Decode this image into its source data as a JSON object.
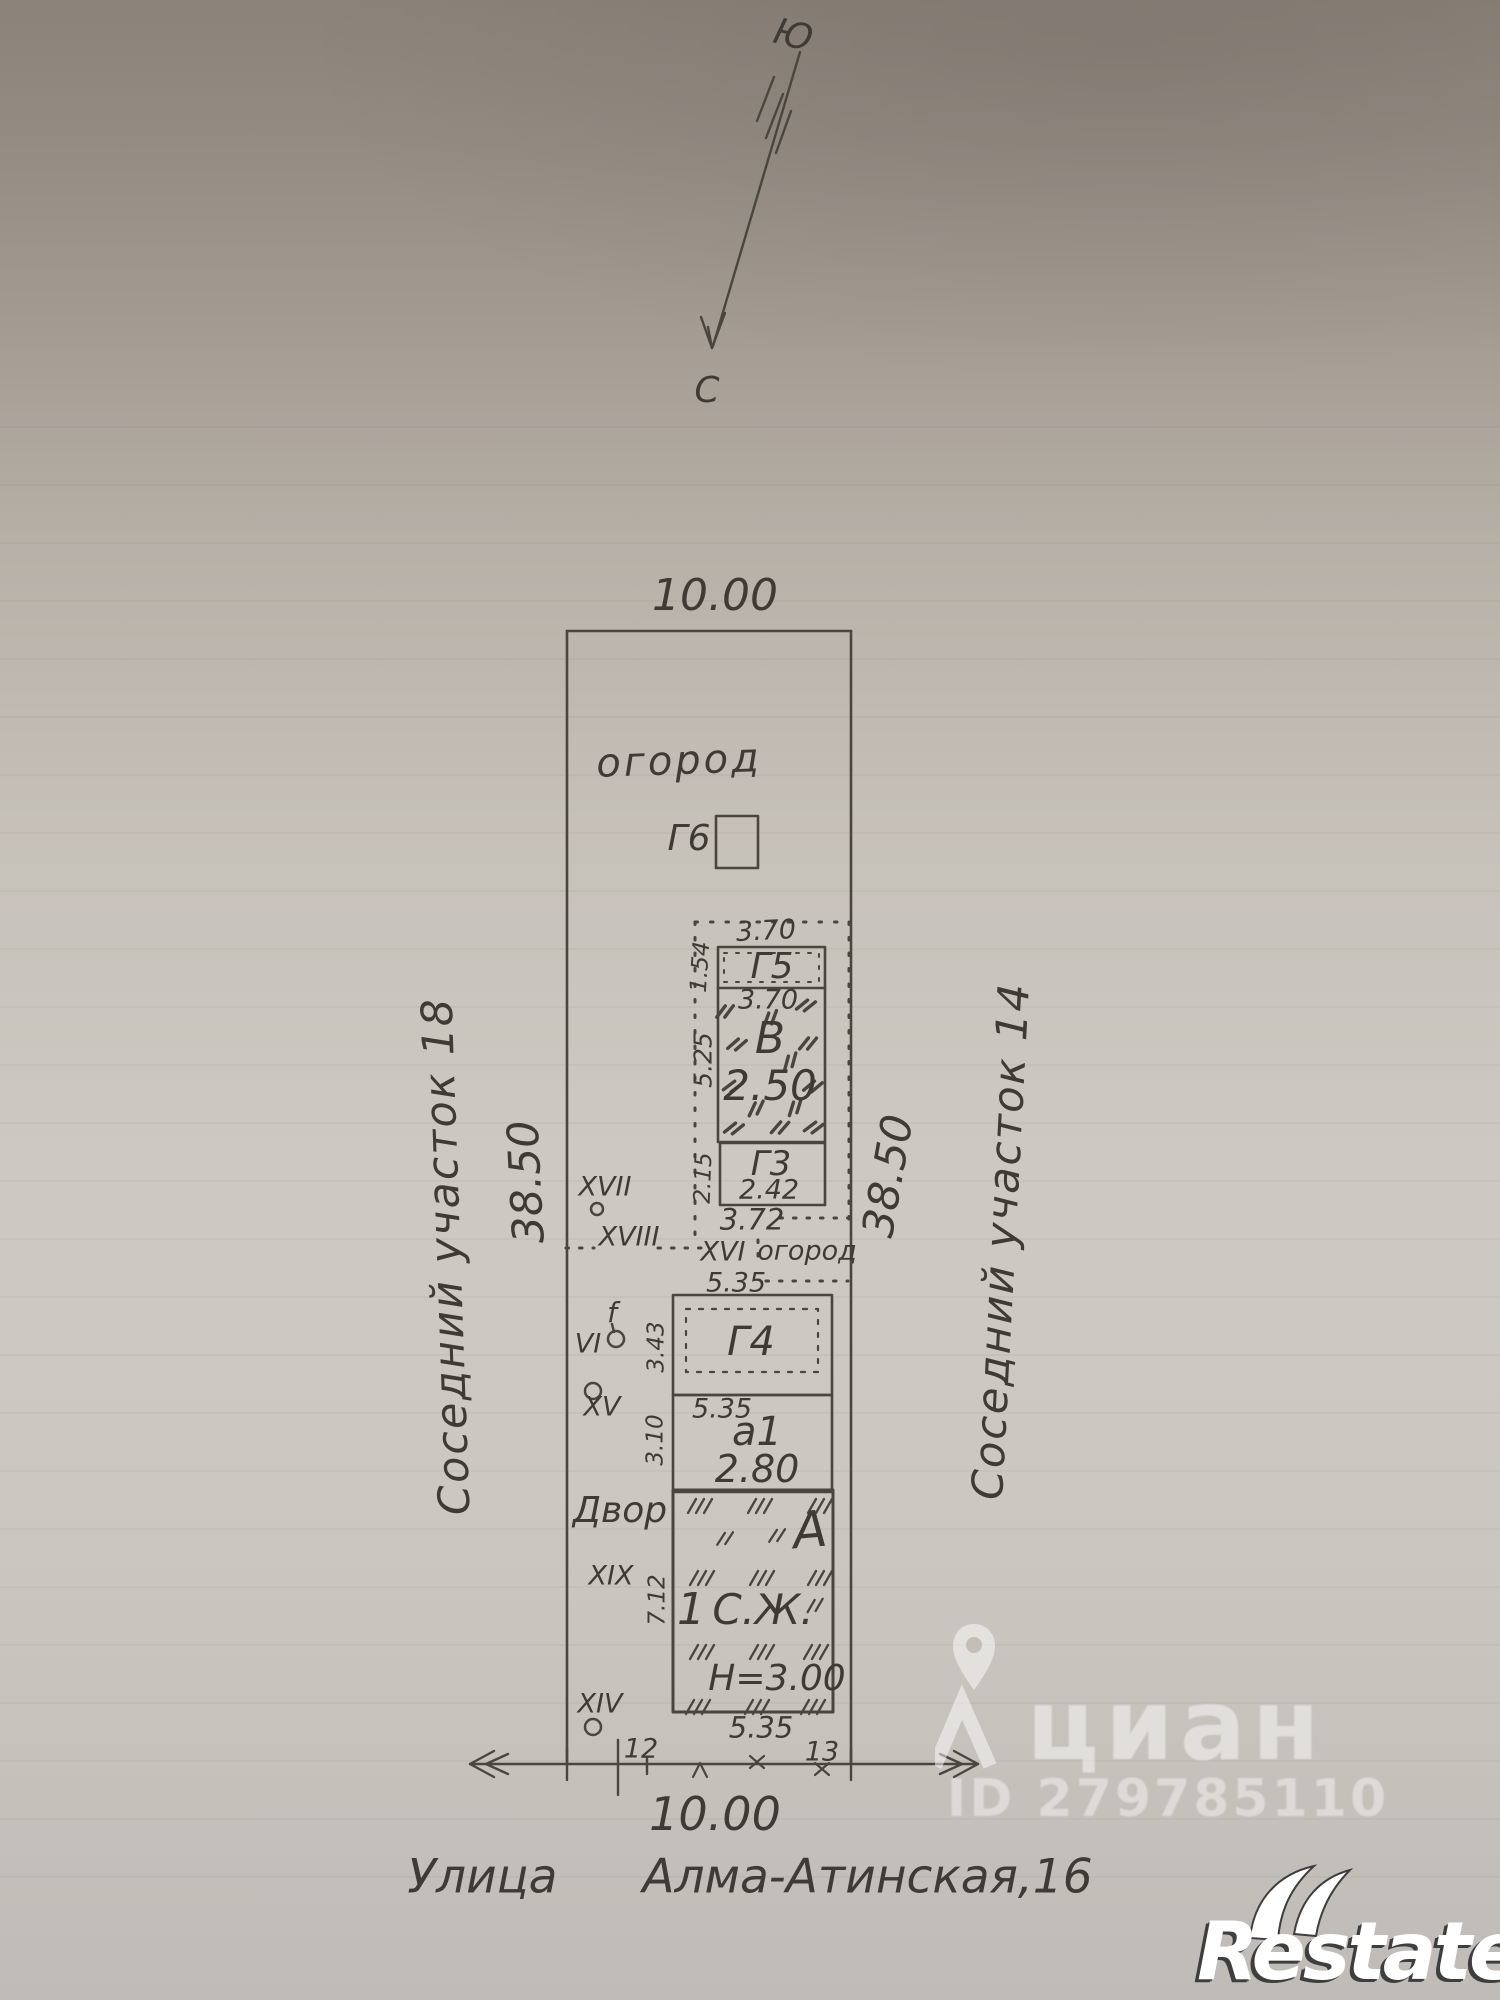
{
  "compass": {
    "south": "Ю",
    "north": "С"
  },
  "plot": {
    "top_width": "10.00",
    "bottom_width": "10.00",
    "left_length": "38.50",
    "right_length": "38.50",
    "left_neighbor": "Соседний участок 18",
    "right_neighbor": "Соседний участок 14",
    "street_name": "Улица Алма-Атинская,16",
    "garden_top": "огород",
    "garden_mid": "огород",
    "yard": "Двор"
  },
  "buildings": {
    "g6": {
      "label": "Г6"
    },
    "g5": {
      "label": "Г5",
      "width": "3.70",
      "depth": "1.54"
    },
    "v": {
      "label": "В",
      "width": "3.70",
      "value": "2.50",
      "depth": "5.25"
    },
    "g3": {
      "label": "Г3",
      "value": "2.42",
      "depth": "2.15",
      "width_below": "3.72"
    },
    "g4": {
      "label": "Г4",
      "width": "5.35",
      "depth": "3.43"
    },
    "a1": {
      "label": "а1",
      "width": "5.35",
      "value": "2.80",
      "depth": "3.10"
    },
    "house": {
      "label": "А",
      "storeys": "1",
      "type": "С.Ж.",
      "height": "Н=3.00",
      "depth": "7.12",
      "width": "5.35"
    }
  },
  "survey_points": {
    "xvii": "XVII",
    "xviii": "XVIII",
    "xvi": "XVI",
    "vi": "VI",
    "f": "f",
    "xv": "XV",
    "xix": "XIX",
    "xiv": "XIV",
    "p12": "12",
    "p13": "13"
  },
  "watermarks": {
    "brand": "циан",
    "listing_id": "ID 279785110",
    "agency": "Restate"
  },
  "ink": {
    "line_color": "#4a463e",
    "text_color": "#3f3b34"
  }
}
